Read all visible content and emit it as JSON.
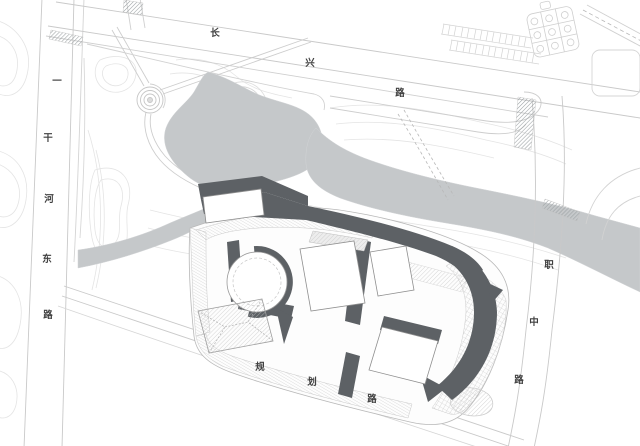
{
  "drawing": {
    "kind_label": "",
    "roads": {
      "left": {
        "name": "一干河东路",
        "chars": [
          "一",
          "干",
          "河",
          "东",
          "路"
        ]
      },
      "top": {
        "name": "长兴路",
        "chars": [
          "长",
          "兴",
          "路"
        ]
      },
      "right": {
        "name": "职中路",
        "chars": [
          "职",
          "中",
          "路"
        ]
      },
      "bottom": {
        "name": "规划路",
        "chars": [
          "规",
          "划",
          "路"
        ]
      }
    },
    "features": {
      "park": "park with pond and circular plaza",
      "river": "gray river band",
      "building": "dark-roof building complex with circular courtyard and crescent block"
    }
  },
  "colors": {
    "background": "#ffffff",
    "water": "#c5c8ca",
    "building_dark": "#5d6165",
    "linework": "#c9c9c9",
    "contour": "#e4e4e4",
    "hatch": "#b9b9b9",
    "text": "#3f3f3f"
  }
}
